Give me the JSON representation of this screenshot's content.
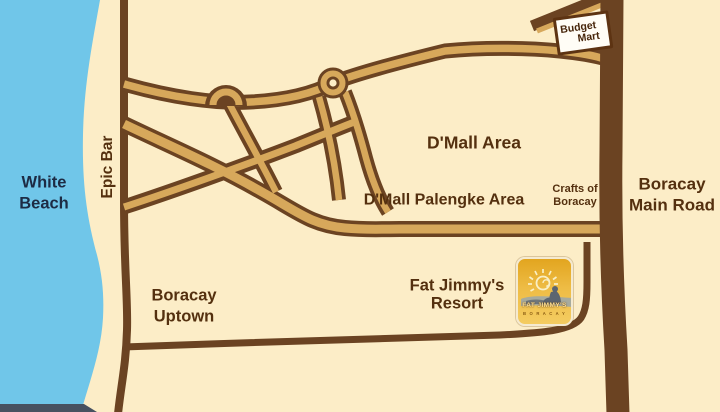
{
  "colors": {
    "water": "#70c6e9",
    "sand": "#fcedc7",
    "road_casing": "#6b4322",
    "road_fill": "#d7a85b",
    "label_brown": "#54300f",
    "label_dark": "#1d2b44",
    "sign_bg": "#fffdf6",
    "sign_border": "#5d3312",
    "strip_dark": "#475160",
    "logo_top": "#e2a51f",
    "logo_bottom": "#f4cc61",
    "logo_text": "#ffe193",
    "logo_tag": "#8a5c12",
    "silhouette": "#5c6570",
    "silhouette_light": "#9aa7ac",
    "sun": "#f9efc5"
  },
  "labels": {
    "white_beach": {
      "line1": "White",
      "line2": "Beach"
    },
    "epic_bar": {
      "text": "Epic Bar"
    },
    "dmall_area": {
      "text": "D'Mall Area"
    },
    "dmall_palengke_area": {
      "text": "D'Mall Palengke Area"
    },
    "crafts_of_boracay": {
      "line1": "Crafts of",
      "line2": "Boracay"
    },
    "boracay_main_road": {
      "line1": "Boracay",
      "line2": "Main Road"
    },
    "boracay_uptown": {
      "line1": "Boracay",
      "line2": "Uptown"
    },
    "fat_jimmys_resort": {
      "line1": "Fat Jimmy's",
      "line2": "Resort"
    },
    "budget_mart": {
      "line1": "Budget",
      "line2": "Mart"
    }
  },
  "logo": {
    "name": "FAT JIMMY'S",
    "tagline": "B O R A C A Y"
  }
}
